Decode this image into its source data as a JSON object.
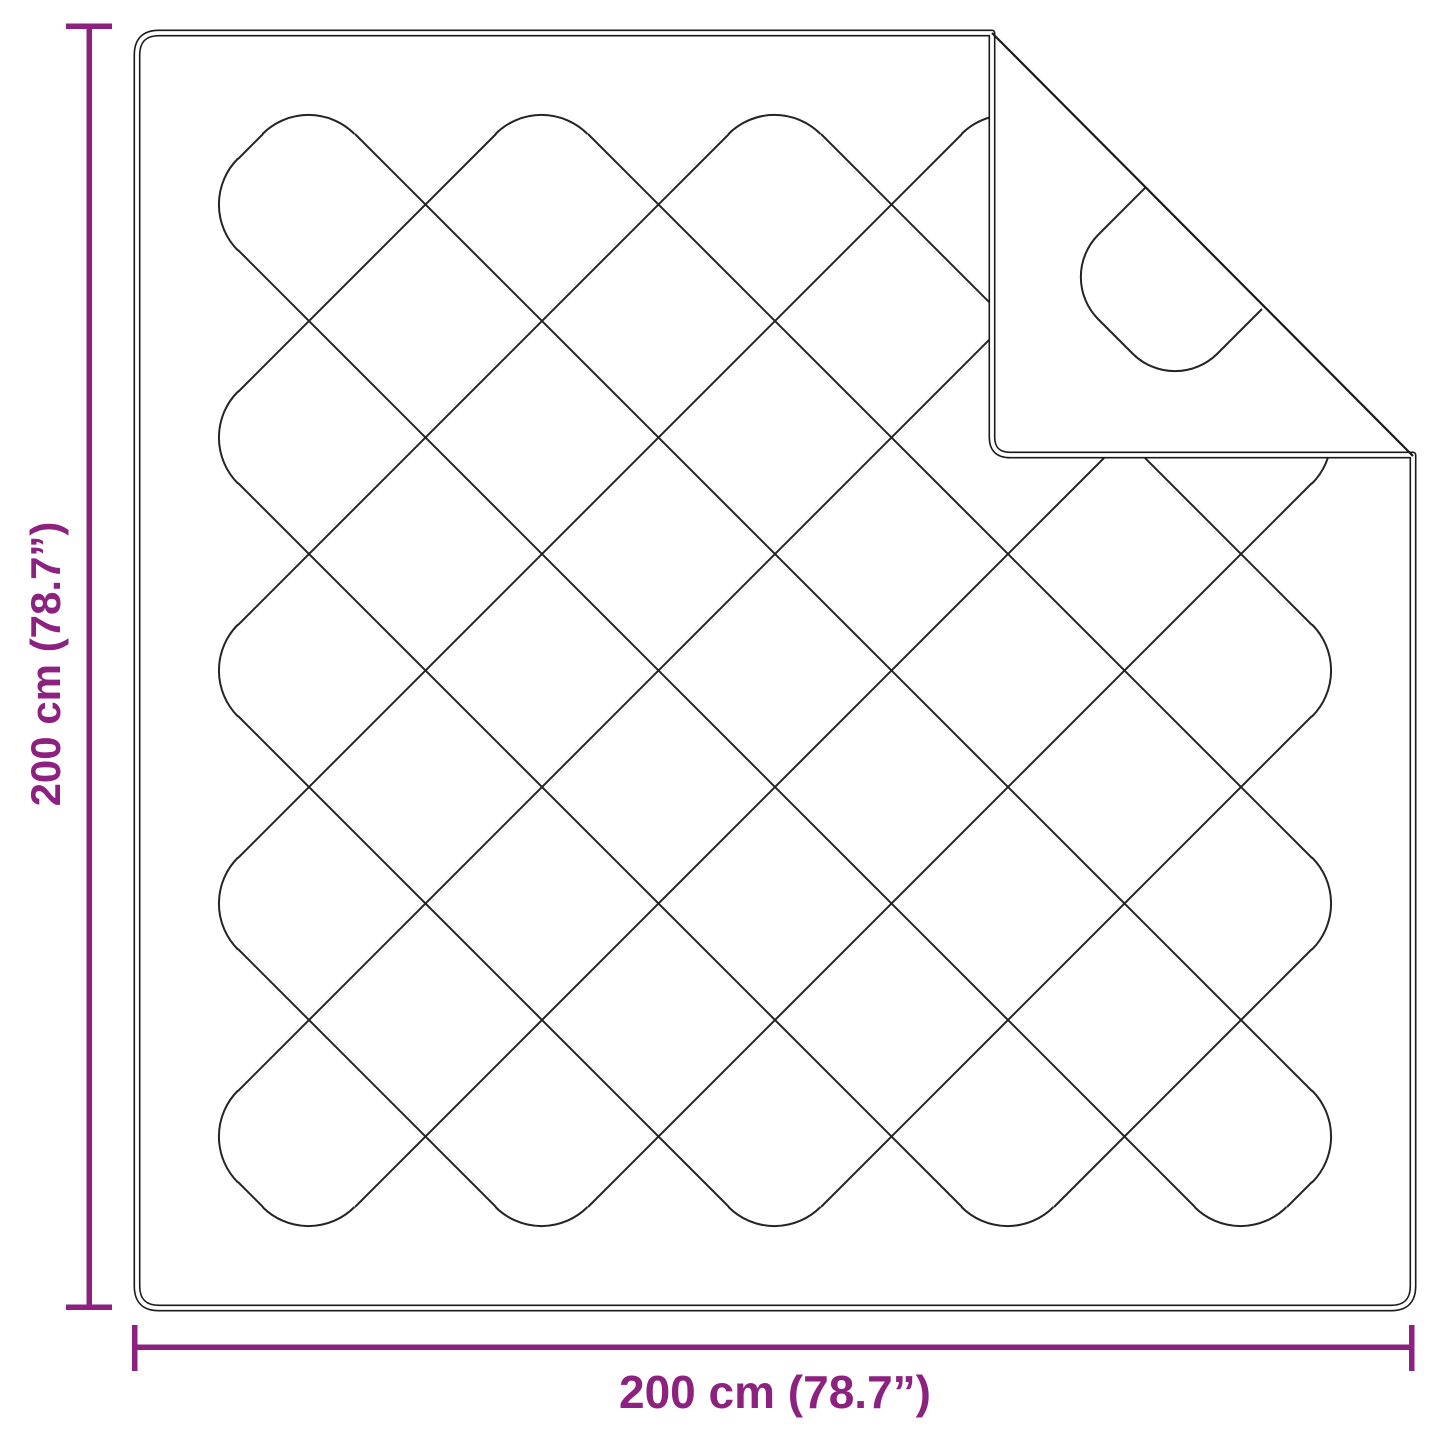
{
  "colors": {
    "accent": "#8d2180",
    "stitch": "#242424",
    "outline": "#1a1a1a",
    "background": "#ffffff"
  },
  "dimensions": {
    "height": {
      "label": "200 cm (78.7”)"
    },
    "width": {
      "label": "200 cm (78.7”)"
    }
  }
}
